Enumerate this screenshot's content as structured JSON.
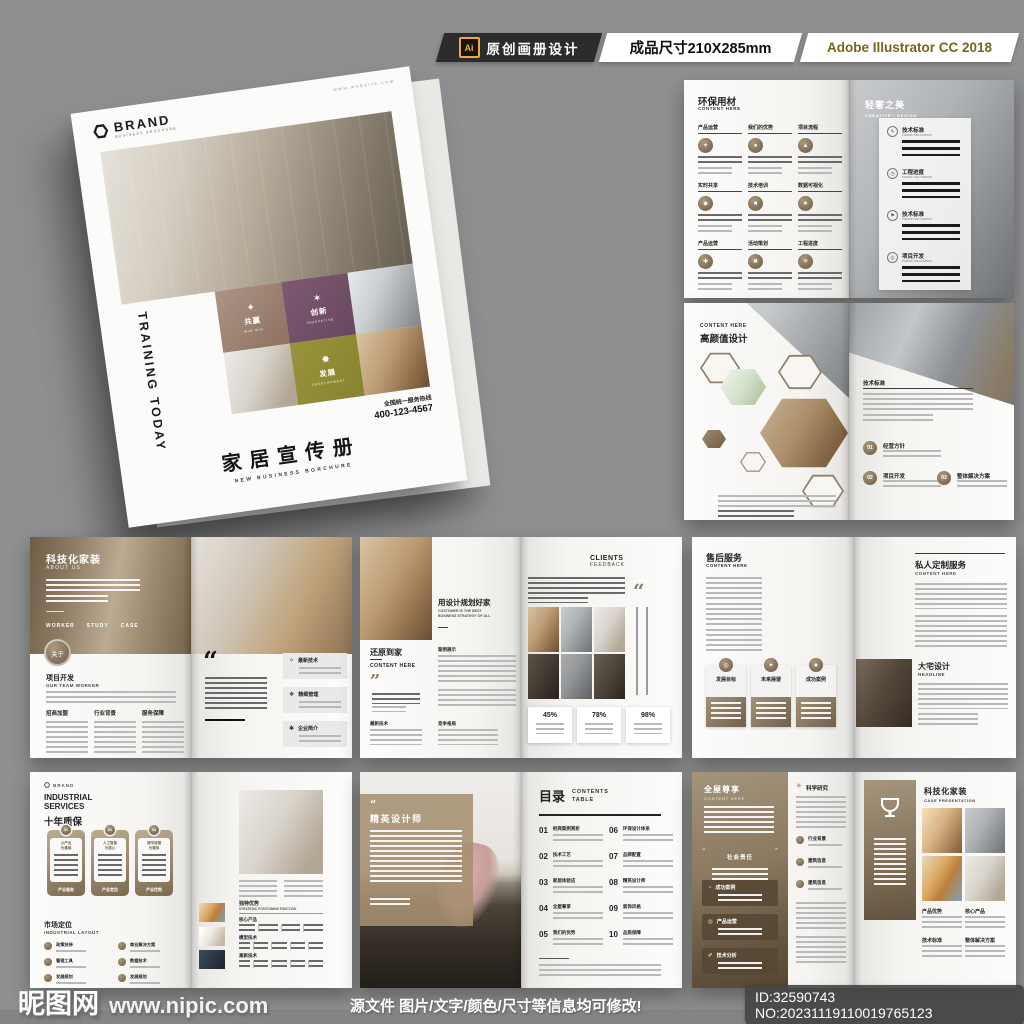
{
  "header": {
    "ai_icon": "Ai",
    "badge_design": "原创画册设计",
    "badge_size": "成品尺寸210X285mm",
    "badge_app": "Adobe Illustrator CC 2018"
  },
  "cover": {
    "website": "www.website.com",
    "brand": "BRAND",
    "brand_sub": "BUSINESS BROCHURE",
    "side_text": "TRAINING TODAY",
    "tiles": [
      {
        "label": "共赢",
        "sub": "WIN-WIN"
      },
      {
        "label": "创新",
        "sub": "INNOVATIVE"
      },
      {
        "label": "发展",
        "sub": "DEVELOPMENT"
      }
    ],
    "hotline_label": "全国统一服务热线",
    "hotline": "400-123-4567",
    "title": "家居宣传册",
    "subtitle": "NEW BUSINESS BORCHURE"
  },
  "spread_eco": {
    "title": "环保用材",
    "subtitle": "CONTENT HERE",
    "grid": [
      "产品运营",
      "我们的优势",
      "项目流程",
      "实时共享",
      "技术培训",
      "数据可视化",
      "产品运营",
      "活动策划",
      "工程进度"
    ],
    "right_title": "轻奢之美",
    "right_subtitle": "CREATIVE / DESIGN",
    "panel": [
      {
        "label": "技术标准",
        "sub": "PURSUE THE COMPANY"
      },
      {
        "label": "工程进度",
        "sub": "PURSUE THE COMPANY"
      },
      {
        "label": "技术标准",
        "sub": "PURSUE THE COMPANY"
      },
      {
        "label": "项目开发",
        "sub": "PURSUE THE COMPANY"
      }
    ]
  },
  "spread_beauty": {
    "eyebrow": "CONTENT HERE",
    "title": "高颜值设计",
    "section": "技术标准",
    "steps": [
      {
        "num": "01",
        "label": "经营方针"
      },
      {
        "num": "02",
        "label": "项目开发"
      },
      {
        "num": "03",
        "label": "整体解决方案"
      }
    ]
  },
  "spread_about": {
    "title": "科技化家装",
    "subtitle": "ABOUT US",
    "menu": [
      "WORKER",
      "STUDY",
      "CASE"
    ],
    "badge": "关于",
    "h2": "项目开发",
    "h2_sub": "OUR TEAM WORKER",
    "columns": [
      "招商加盟",
      "行业背景",
      "服务保障"
    ],
    "boxes": [
      "最新技术",
      "精细管理",
      "企业简介"
    ]
  },
  "spread_plan": {
    "title": "用设计规划好家",
    "subtitle_l1": "CUSTOMER IS THE BEST",
    "subtitle_l2": "BUSINESS STRATEGY OF ALL",
    "h2": "还原到家",
    "h2_sub": "CONTENT HERE",
    "mid_label": "案例展示",
    "foot_labels": [
      "最新技术",
      "竞争格局"
    ],
    "right_title": "CLIENTS",
    "right_subtitle": "FEEDBACK",
    "stats": [
      "45%",
      "78%",
      "98%"
    ]
  },
  "spread_service": {
    "title": "售后服务",
    "subtitle": "CONTENT HERE",
    "cards": [
      "发展目标",
      "未来展望",
      "成功案例"
    ],
    "right_title": "私人定制服务",
    "right_subtitle": "CONTENT HERE",
    "h2": "大宅设计",
    "h2_sub": "HEADLINE"
  },
  "spread_industrial": {
    "brand": "BRAND",
    "title_l1": "INDUSTRIAL",
    "title_l2": "SERVICES",
    "title_cn": "十年质保",
    "bubbles": [
      {
        "num": "01",
        "line1": "以产业",
        "line2": "为基础",
        "label": "产业服务"
      },
      {
        "num": "02",
        "line1": "人工智能",
        "line2": "为核心",
        "label": "产业定位"
      },
      {
        "num": "03",
        "line1": "城市运营",
        "line2": "为载体",
        "label": "产业优势"
      }
    ],
    "h2": "市场定位",
    "h2_sub": "INDUSTRIAL LAYOUT",
    "layout_items": [
      "政策扶持",
      "管理工具",
      "发展规划",
      "商业解决方案",
      "数据技术",
      "发展规划"
    ],
    "right_h1": "独特优势",
    "right_h1_sub": "STRATEGIC POSITIONING FUNCTION",
    "right_rows": [
      "核心产品",
      "模型技术",
      "高新技术"
    ]
  },
  "spread_designer": {
    "title": "精英设计师",
    "toc_title": "目录",
    "toc_sub_l1": "CONTENTS",
    "toc_sub_l2": "TABLE",
    "toc": [
      {
        "num": "01",
        "label": "经典案例赏析"
      },
      {
        "num": "02",
        "label": "技术工艺"
      },
      {
        "num": "03",
        "label": "家居体验店"
      },
      {
        "num": "04",
        "label": "全屋尊享"
      },
      {
        "num": "05",
        "label": "我们的优势"
      },
      {
        "num": "06",
        "label": "环保设计体系"
      },
      {
        "num": "07",
        "label": "品牌配置"
      },
      {
        "num": "08",
        "label": "精英设计师"
      },
      {
        "num": "09",
        "label": "装饰风格"
      },
      {
        "num": "10",
        "label": "品质保障"
      }
    ]
  },
  "spread_whole": {
    "title": "全屋尊享",
    "subtitle": "CONTENT HERE",
    "badge": "社会责任",
    "boxes": [
      "成功案例",
      "产品运营",
      "技术分析"
    ],
    "mid_title": "科学研究",
    "mid_items": [
      "行业背景",
      "建筑信息",
      "建筑信息"
    ],
    "right_title": "科技化家装",
    "right_subtitle": "CASE PRESENTATION",
    "right_labels": [
      "产品优势",
      "核心产品",
      "技术标准",
      "整体解决方案"
    ]
  },
  "footer": {
    "site": "昵图网",
    "url": "www.nipic.com",
    "notice": "源文件 图片/文字/颜色/尺寸等信息均可修改!",
    "id": "ID:32590743 NO:20231119110019765123"
  },
  "icons": {
    "win": "✦",
    "innovate": "✶",
    "develop": "✸",
    "grid": [
      "✦",
      "●",
      "▲",
      "◆",
      "■",
      "★",
      "✚",
      "✖",
      "✳"
    ],
    "panel": [
      "✎",
      "◷",
      "⚑",
      "◎"
    ],
    "about_boxes": [
      "✧",
      "❖",
      "✱"
    ],
    "service_cards": [
      "◎",
      "✦",
      "★"
    ],
    "whole_boxes": [
      "◔",
      "◎",
      "✐"
    ],
    "science": "✳",
    "quote_open": "“",
    "quote_close": "”"
  },
  "colors": {
    "accent": "#8d7a5f",
    "purple": "#7b5a72",
    "olive": "#8b8f2e",
    "background": "#8e8f90"
  }
}
